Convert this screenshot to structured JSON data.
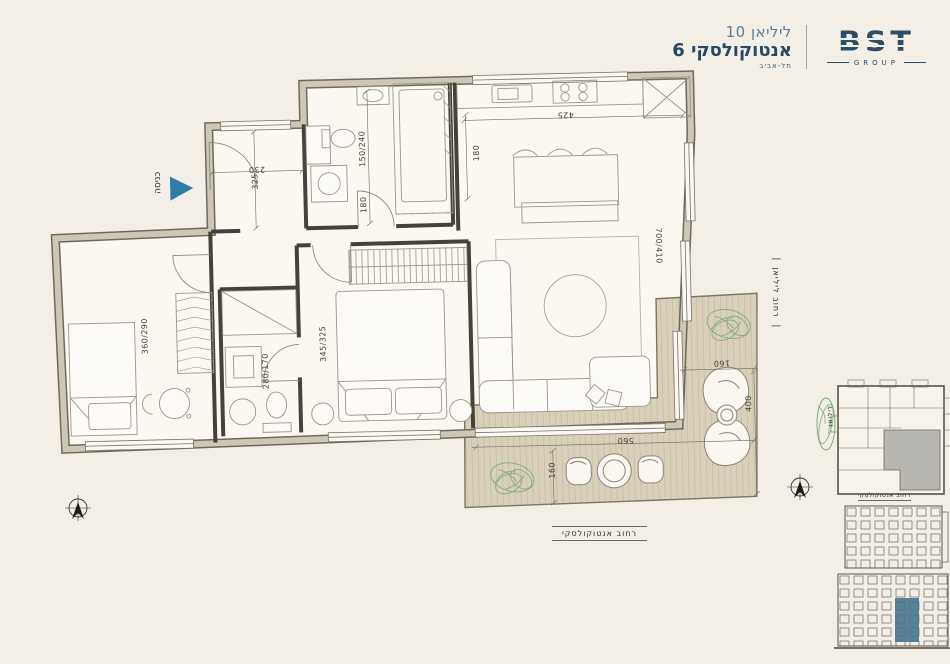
{
  "header": {
    "project_line1": "ליליאן 10",
    "project_line2": "אנטוקולסקי 6",
    "project_city": "תל-אביב",
    "logo_text": "BST",
    "logo_sub": "GROUP"
  },
  "plan": {
    "entrance_label": "כניסה",
    "dimensions": [
      {
        "text": "230",
        "x": 260,
        "y": 166,
        "rot": 180
      },
      {
        "text": "325",
        "x": 258,
        "y": 178,
        "rot": -90
      },
      {
        "text": "150/240",
        "x": 366,
        "y": 148,
        "rot": -90
      },
      {
        "text": "180",
        "x": 366,
        "y": 204,
        "rot": -90
      },
      {
        "text": "425",
        "x": 570,
        "y": 119,
        "rot": 180
      },
      {
        "text": "180",
        "x": 480,
        "y": 155,
        "rot": -90
      },
      {
        "text": "700/410",
        "x": 660,
        "y": 252,
        "rot": 90
      },
      {
        "text": "360/290",
        "x": 144,
        "y": 330,
        "rot": -90
      },
      {
        "text": "345/325",
        "x": 322,
        "y": 342,
        "rot": -90
      },
      {
        "text": "280/170",
        "x": 264,
        "y": 368,
        "rot": -90
      },
      {
        "text": "160",
        "x": 720,
        "y": 371,
        "rot": 180
      },
      {
        "text": "400",
        "x": 746,
        "y": 412,
        "rot": -90
      },
      {
        "text": "560",
        "x": 622,
        "y": 446,
        "rot": 180
      },
      {
        "text": "160",
        "x": 548,
        "y": 474,
        "rot": -90
      }
    ],
    "captions": {
      "bottom_street": "רחוב אנטוקולסקי",
      "right_street": "רחוב ליליאן",
      "siteplan_street": "רחוב אנטוקולסקי",
      "siteplan_plant_label": "ליליאן"
    }
  },
  "colors": {
    "accent_blue": "#2d7ea7",
    "brand_navy": "#2e4d66",
    "highlight_unit": "#49768e",
    "plant_green": "#74a874",
    "wall_fill": "#cfc7b6"
  }
}
